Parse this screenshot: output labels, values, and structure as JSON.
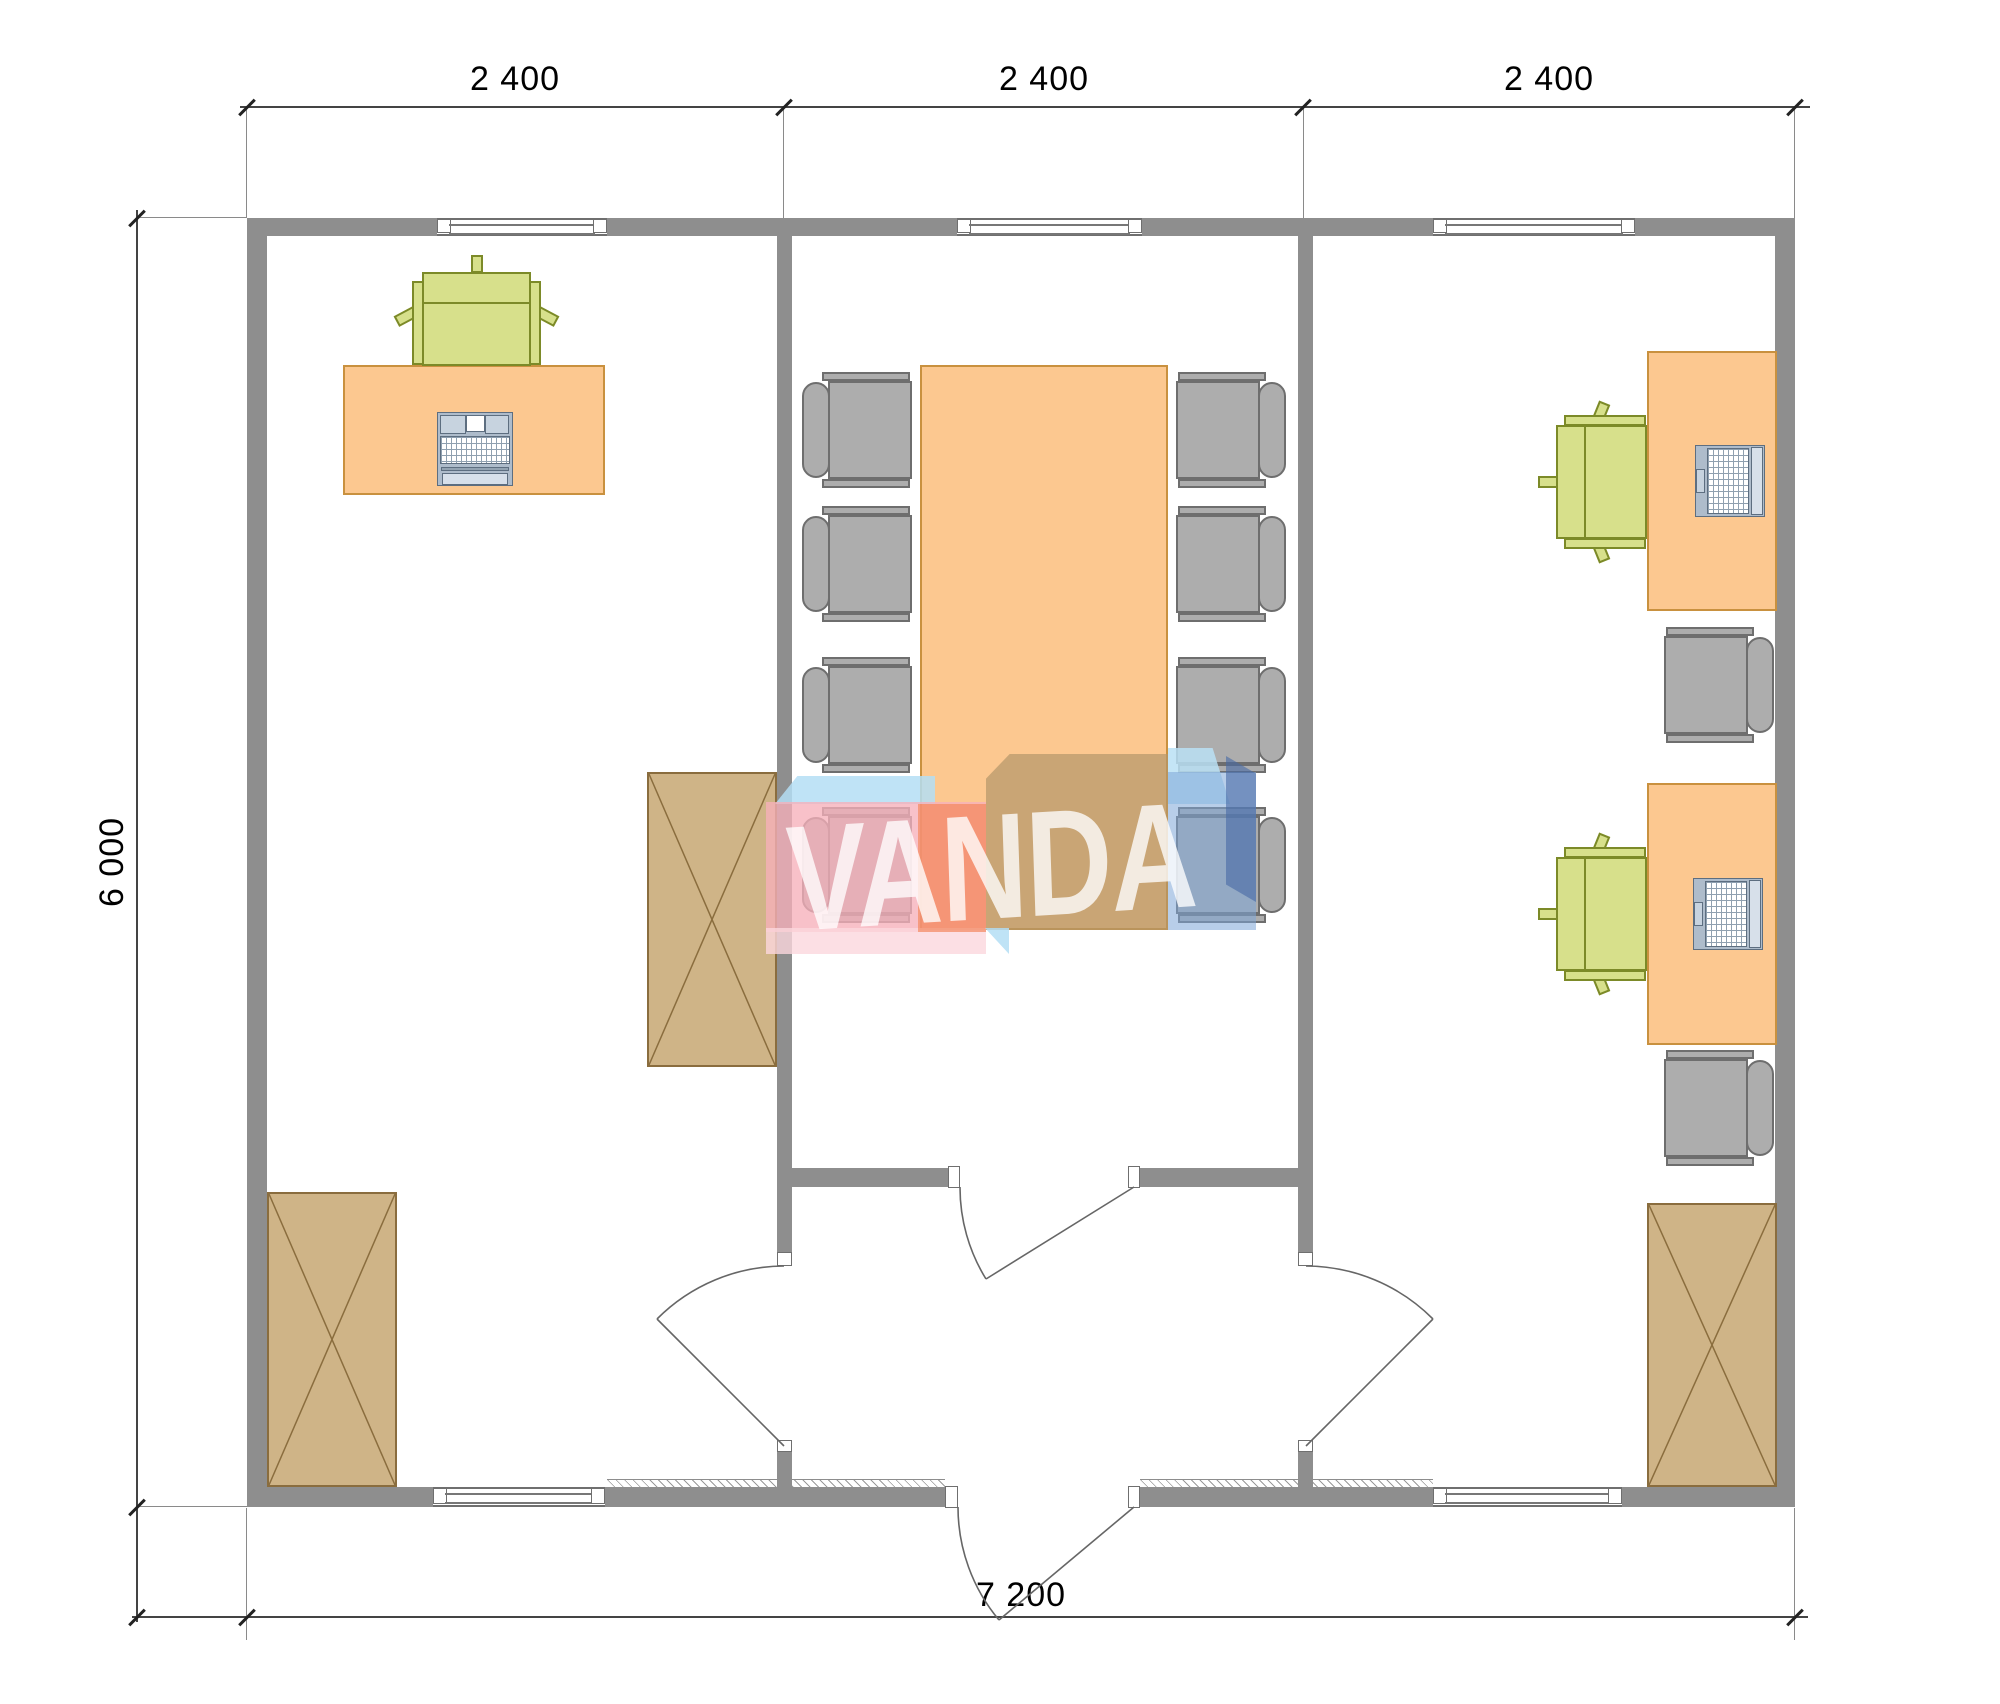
{
  "drawing": {
    "type": "architectural-floor-plan",
    "rooms": [
      {
        "name": "left-office",
        "furniture": [
          "desk",
          "desk-chair",
          "keyboard-workstation",
          "storage-cabinet",
          "storage-cabinet"
        ]
      },
      {
        "name": "meeting-room",
        "furniture": [
          "conference-table",
          "meeting-chair x8"
        ]
      },
      {
        "name": "right-office",
        "furniture": [
          "desk x2",
          "desk-chair x2",
          "laptop x2",
          "visitor-chair x2",
          "storage-cabinet"
        ]
      },
      {
        "name": "entrance-hall",
        "furniture": []
      }
    ],
    "doors": [
      "entrance-door",
      "hall-to-meeting-door",
      "hall-to-left-office-door",
      "hall-to-right-office-door"
    ]
  },
  "dimensions": {
    "top": {
      "segments": [
        {
          "label": "2 400"
        },
        {
          "label": "2 400"
        },
        {
          "label": "2 400"
        }
      ]
    },
    "left": {
      "label": "6 000"
    },
    "bottom": {
      "label": "7 200"
    }
  },
  "watermark": {
    "text": "VANDA"
  },
  "palette": {
    "wall": "#8e8e8e",
    "desk": "#fcc890",
    "desk_stroke": "#c9913f",
    "cabinet": "#cfb487",
    "cabinet_stroke": "#8a6d3e",
    "chair_green": "#d7e08b",
    "chair_green_stroke": "#7c8a28",
    "chair_gray": "#adadad",
    "chair_gray_stroke": "#6e6e6e",
    "laptop": "#c5d2e0",
    "logo_pink": "#f8b0ba",
    "logo_light_pink": "#fbd7dd",
    "logo_blue": "#b4def4",
    "logo_steel_blue": "#7da5d7",
    "logo_navy": "#4669a5",
    "logo_orange": "#f4804e",
    "logo_tan": "#b4966e",
    "logo_letters": "#ffffff"
  }
}
